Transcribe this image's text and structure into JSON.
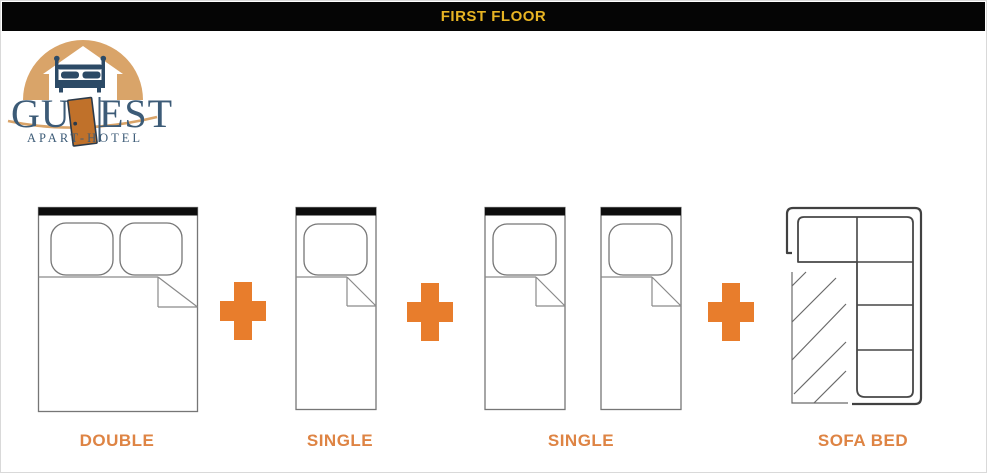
{
  "header": {
    "title": "FIRST FLOOR"
  },
  "logo": {
    "word_part1": "GU",
    "word_part2": "EST",
    "subtitle": "APART-HOTEL"
  },
  "diagram": {
    "groups": [
      {
        "type": "double-bed",
        "label": "DOUBLE"
      },
      {
        "type": "single-bed",
        "label": "SINGLE"
      },
      {
        "type": "two-single-beds",
        "label": "SINGLE"
      },
      {
        "type": "sofa-bed",
        "label": "SOFA BED"
      }
    ],
    "separator_icon": "plus-icon"
  },
  "colors": {
    "gold": "#E7B423",
    "plus": "#E87D2C",
    "label": "#DE8444",
    "tan": "#D9A469",
    "navy": "#2C4A66",
    "door": "#C0712A"
  }
}
